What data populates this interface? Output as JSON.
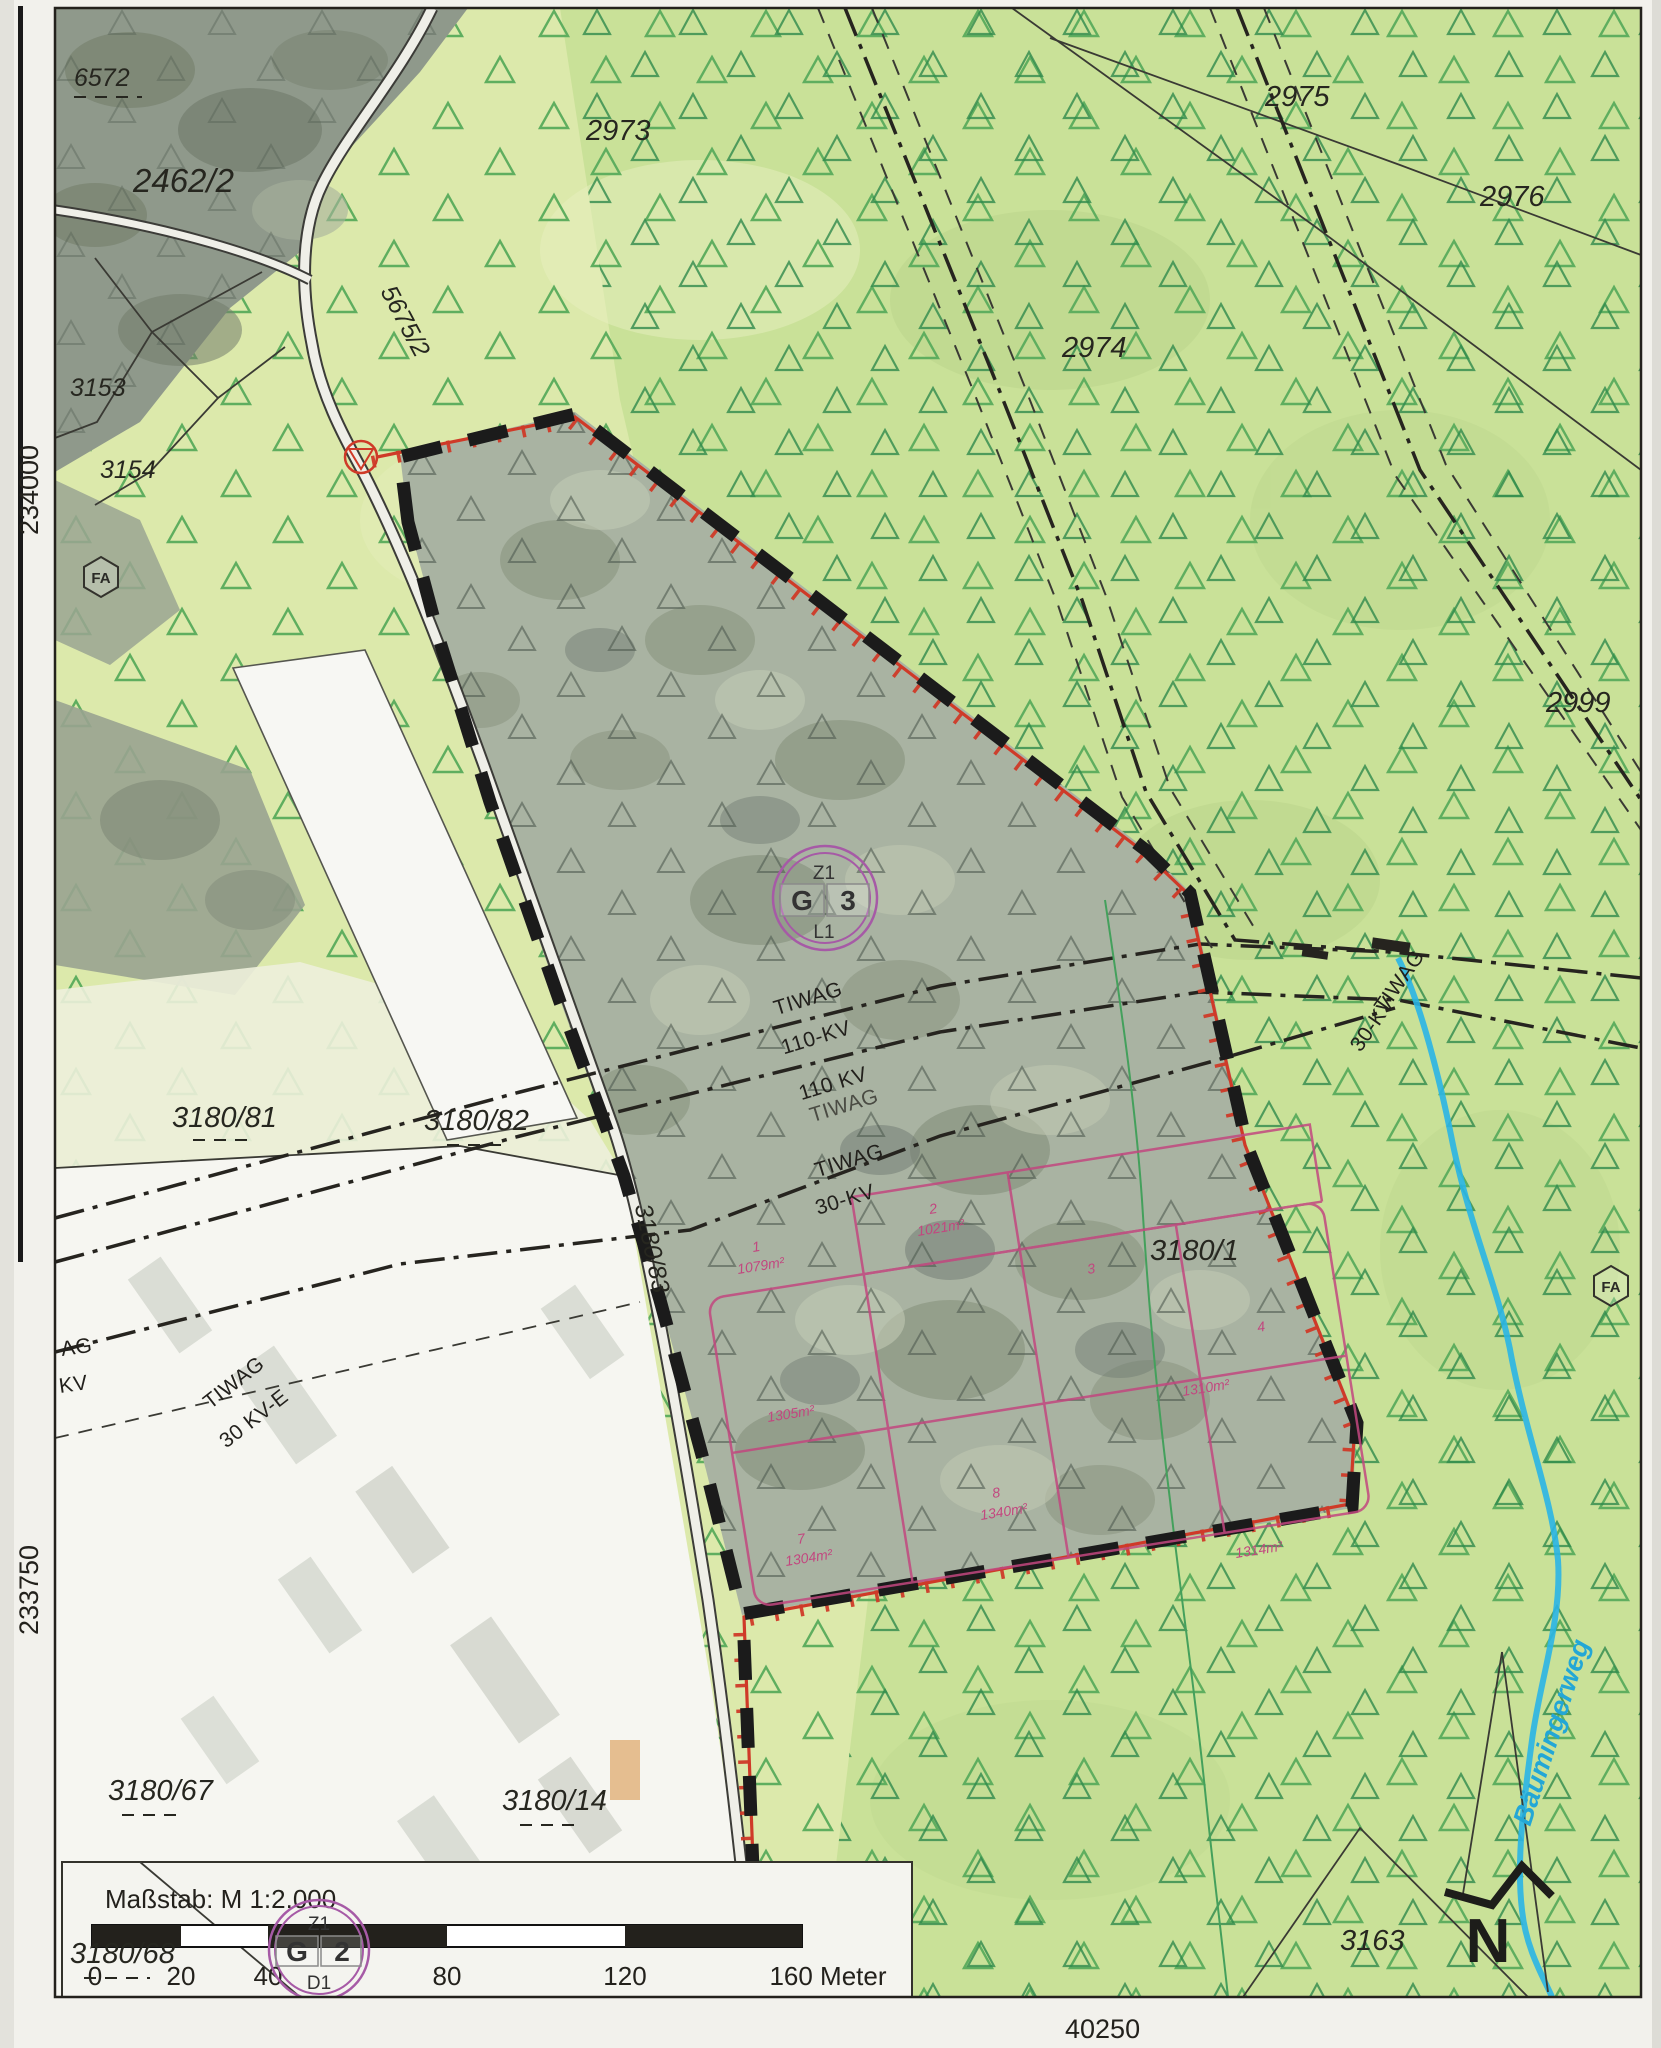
{
  "map_meta": {
    "coord_left_top": "234000",
    "coord_left_bottom": "233750",
    "coord_bottom": "40250",
    "waterway_label": "Bäumingerweg",
    "north_letter": "N"
  },
  "legend": {
    "scale_text": "Maßstab: M 1:2.000",
    "ticks": [
      "0",
      "20",
      "40",
      "80",
      "120",
      "160 Meter"
    ]
  },
  "parcel_labels": [
    {
      "text": "6572"
    },
    {
      "text": "2462/2"
    },
    {
      "text": "2973"
    },
    {
      "text": "2975"
    },
    {
      "text": "2976"
    },
    {
      "text": "2974"
    },
    {
      "text": "3153"
    },
    {
      "text": "3154"
    },
    {
      "text": "2999"
    },
    {
      "text": "3180/81"
    },
    {
      "text": "3180/82"
    },
    {
      "text": "3180/1"
    },
    {
      "text": "3180/67"
    },
    {
      "text": "3180/14"
    },
    {
      "text": "3180/68"
    },
    {
      "text": "3163"
    }
  ],
  "road_labels": [
    "5675/2",
    "3180/83"
  ],
  "powerline_labels": [
    "TIWAG",
    "110-KV",
    "110 KV",
    "TIWAG",
    "TIWAG",
    "30-KV",
    "AG",
    "KV",
    "TIWAG",
    "30 KV-E",
    "TIWAG",
    "30-KV"
  ],
  "plan_symbols": {
    "g3": {
      "top": "Z1",
      "left": "G",
      "right": "3",
      "bottom": "L1"
    },
    "g2": {
      "top": "Z1",
      "left": "G",
      "right": "2",
      "bottom": "D1"
    },
    "fa": "FA"
  },
  "subdivision": {
    "numbers": [
      "1",
      "2",
      "3",
      "4",
      "7",
      "8"
    ],
    "areas": [
      "1079m²",
      "1021m²",
      "1305m²",
      "1304m²",
      "1340m²",
      "1310m²",
      "1314m²"
    ]
  },
  "colors": {
    "boundary_red": "#cf3a28",
    "boundary_black": "#1b1b1b",
    "subdivision_pink": "#c2477f",
    "water_cyan": "#2ab5e5",
    "plan_purple": "#a65aa6",
    "forest_green": "#dce9ab"
  }
}
